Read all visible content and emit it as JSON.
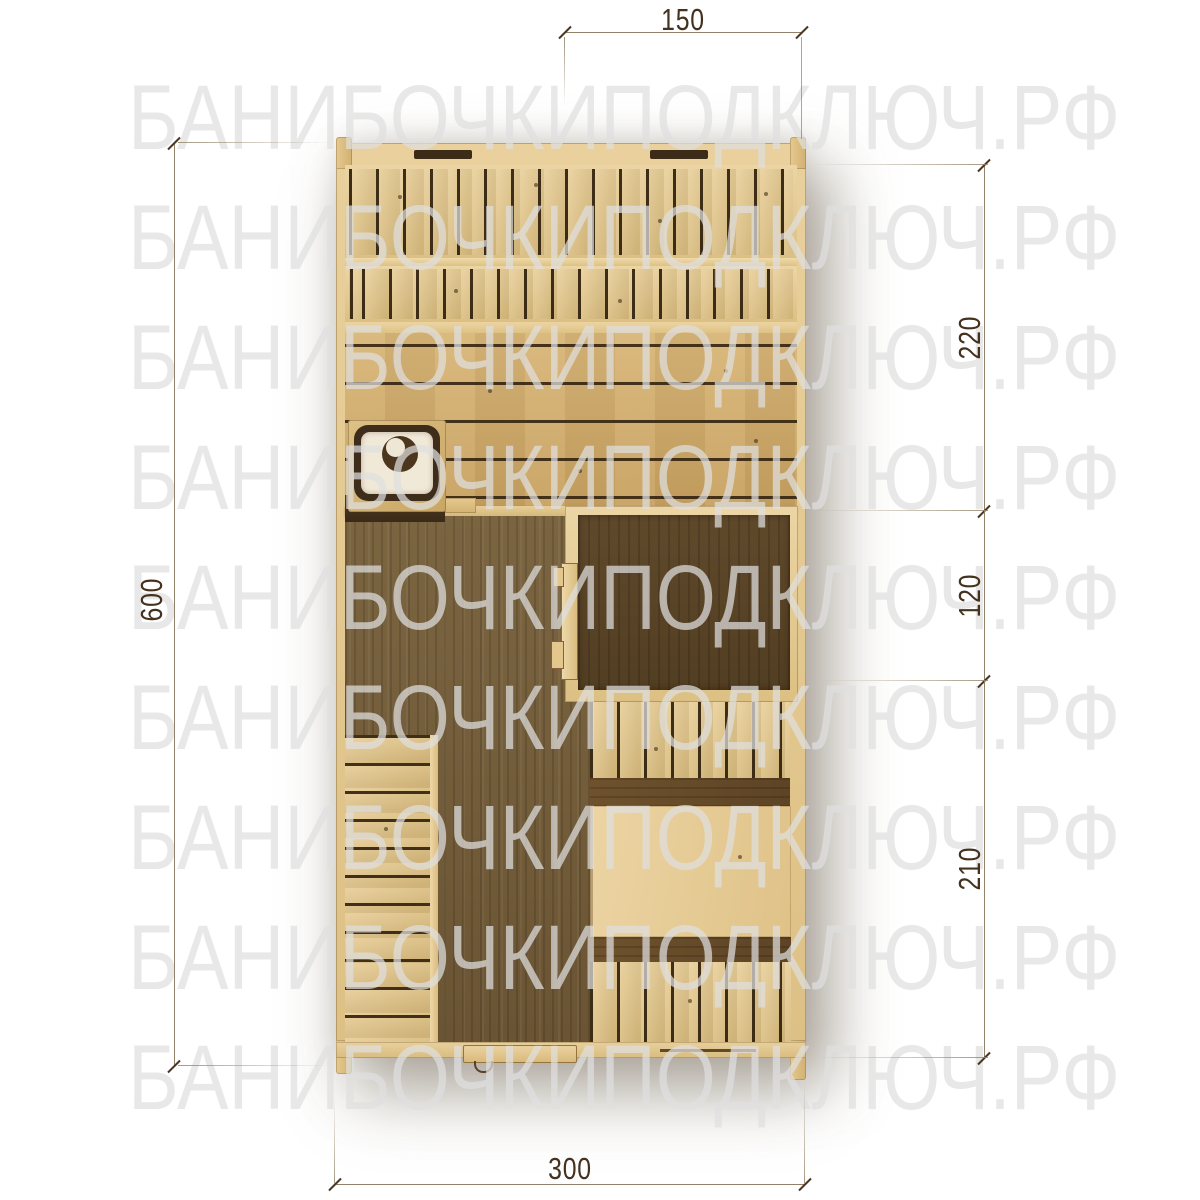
{
  "watermark": {
    "text": "БАНИБОЧКИПОДКЛЮЧ.РФ",
    "row_count": 9
  },
  "dimensions": {
    "top": {
      "label": "150"
    },
    "right_upper": {
      "label": "220"
    },
    "right_middle": {
      "label": "120"
    },
    "right_lower": {
      "label": "210"
    },
    "left": {
      "label": "600"
    },
    "bottom": {
      "label": "300"
    }
  },
  "palette": {
    "wood_light": "#e6cc95",
    "wood_planks": "#d0ab6b",
    "wood_floor_dark": "#6f5937",
    "wood_steam_floor": "#5a452a",
    "stove_frame": "#3e2d1a",
    "stove_top": "#f1e9d8",
    "dimension_line": "#93826a",
    "dimension_text": "#44321e",
    "watermark_gray": "#e9e9e9"
  }
}
